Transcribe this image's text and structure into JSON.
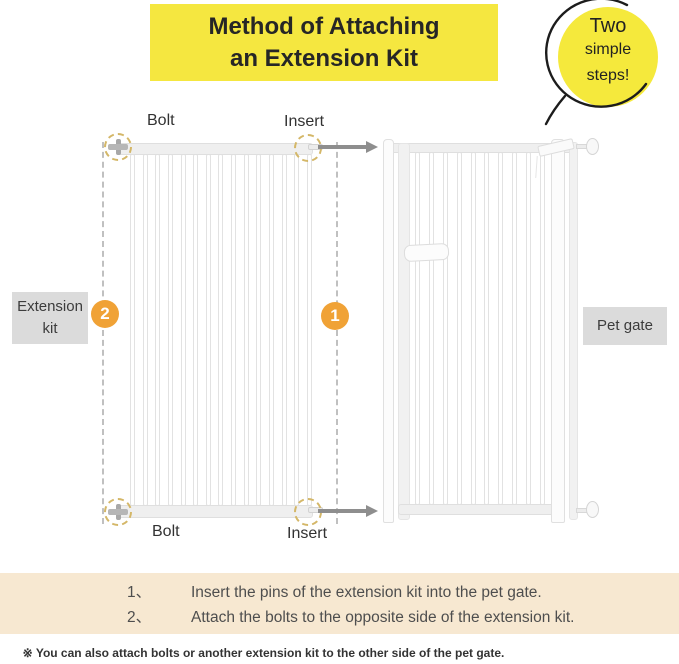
{
  "title": {
    "line1": "Method of Attaching",
    "line2": "an Extension Kit"
  },
  "badge": {
    "line1": "Two",
    "line2": "simple",
    "line3": "steps!"
  },
  "diagram": {
    "bolt_label_top": "Bolt",
    "insert_label_top": "Insert",
    "bolt_label_bottom": "Bolt",
    "insert_label_bottom": "Insert",
    "extension_kit_label": "Extension kit",
    "pet_gate_label": "Pet gate",
    "step_marker_1": "1",
    "step_marker_2": "2"
  },
  "instructions": {
    "items": [
      {
        "num": "1、",
        "text": "Insert the pins of the extension kit into the pet gate."
      },
      {
        "num": "2、",
        "text": "Attach the bolts to the opposite side of the extension kit."
      }
    ],
    "note": "※ You can also attach bolts or another extension kit to the other side of the pet gate."
  },
  "colors": {
    "title_bg": "#F5E740",
    "badge_bg": "#F5E93C",
    "step_badge_orange": "#F0A236",
    "instructions_bg": "#F7E8D1",
    "label_bg": "#DBDBDB",
    "highlight_dash_gold": "#D4B768",
    "arrow_gray": "#8E8E8E"
  }
}
